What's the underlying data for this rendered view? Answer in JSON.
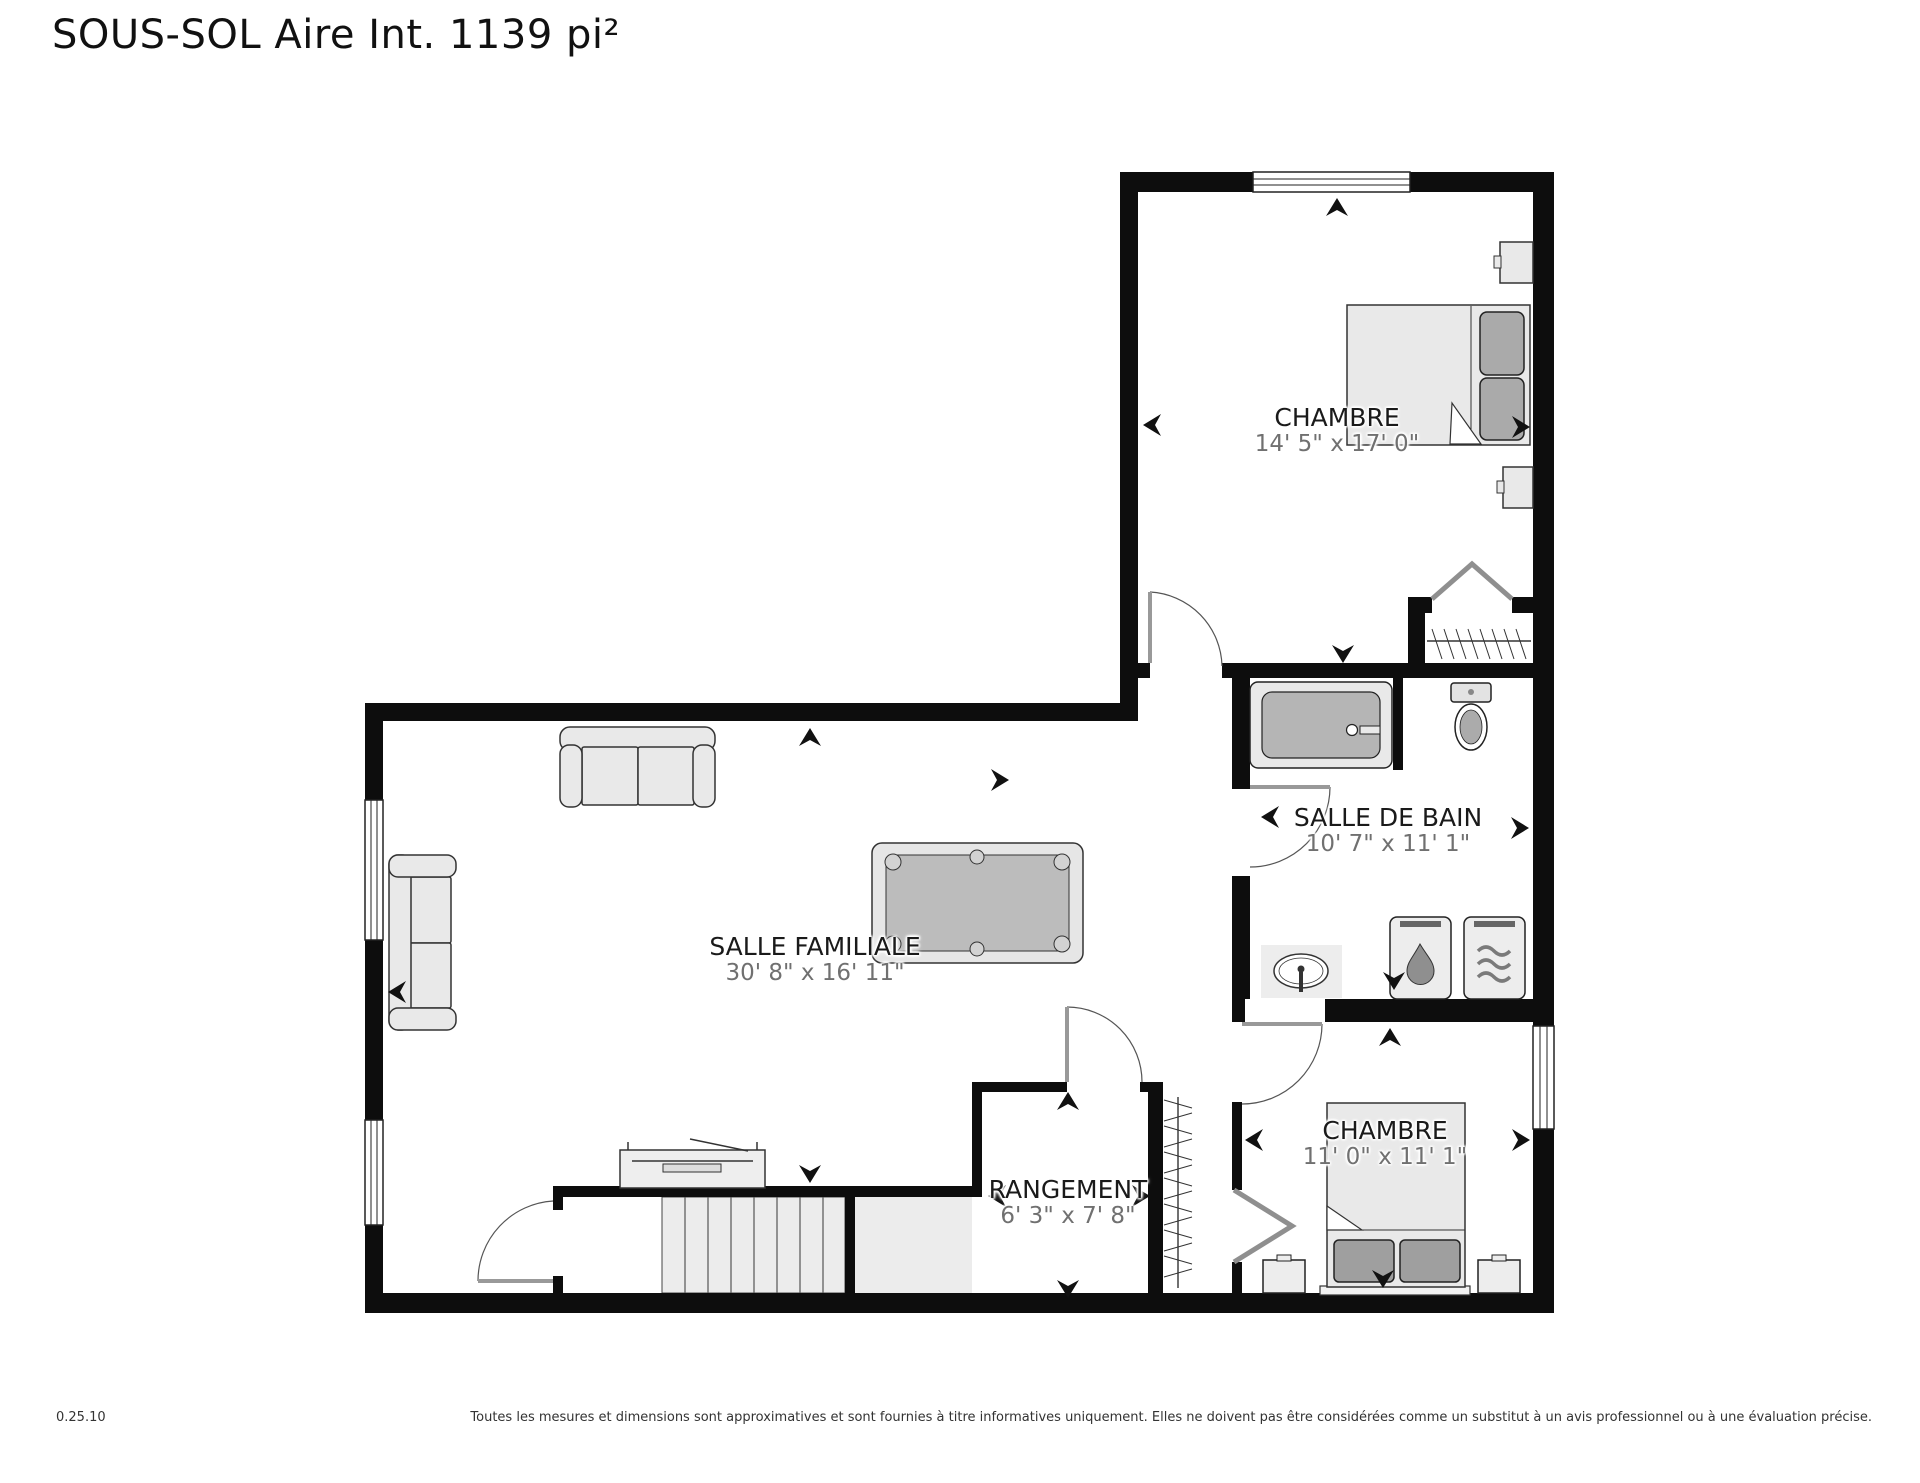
{
  "title": "SOUS-SOL Aire Int. 1139 pi²",
  "rooms": {
    "chambre_1": {
      "name": "CHAMBRE",
      "dims": "14' 5\" x 17' 0\""
    },
    "salle_de_bain": {
      "name": "SALLE DE BAIN",
      "dims": "10' 7\" x 11' 1\""
    },
    "salle_familiale": {
      "name": "SALLE FAMILIALE",
      "dims": "30' 8\" x 16' 11\""
    },
    "rangement": {
      "name": "RANGEMENT",
      "dims": "6' 3\" x 7' 8\""
    },
    "chambre_2": {
      "name": "CHAMBRE",
      "dims": "11' 0\" x 11' 1\""
    }
  },
  "footer": {
    "version": "0.25.10",
    "disclaimer": "Toutes les mesures et dimensions sont approximatives et sont fournies à titre informatives uniquement. Elles ne doivent pas être considérées comme un substitut à un avis professionnel ou à une évaluation précise."
  },
  "colors": {
    "wall": "#0d0d0d",
    "room_label": "#1a1a1a",
    "dimension_label": "#707070",
    "furniture_fill": "#e9e9e9",
    "furniture_stroke": "#333333",
    "soft_furnishing": "#b0b0b0",
    "measure_arrow": "#111111",
    "background": "#ffffff"
  },
  "icons": {
    "water_heater": "droplet-icon",
    "furnace": "heat-waves-icon",
    "closet_rail": "clothes-rail-hatch-icon",
    "measure_arrows": "dart-arrow-icon"
  }
}
